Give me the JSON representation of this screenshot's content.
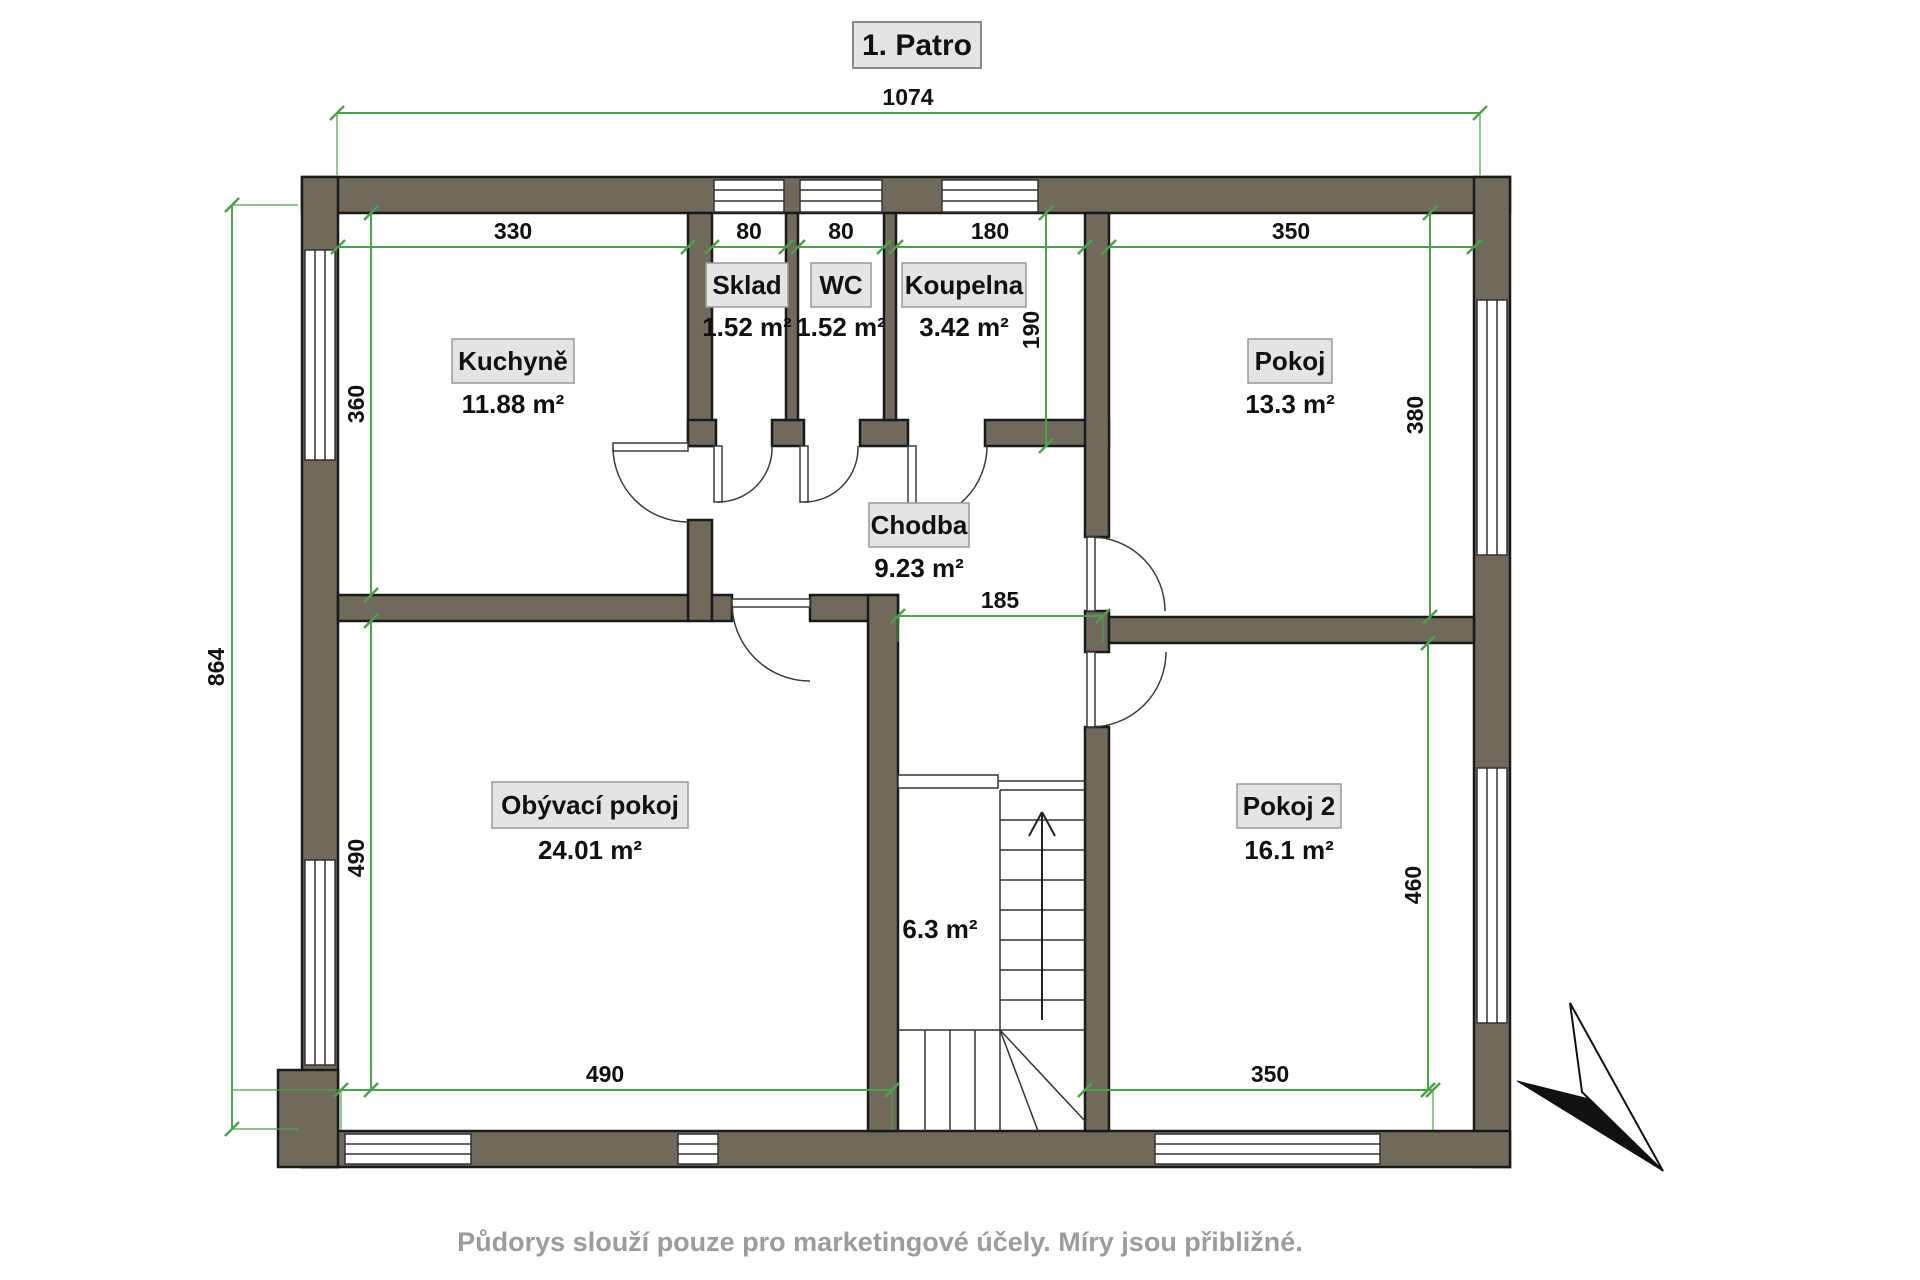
{
  "title": "1. Patro",
  "footer": "Půdorys slouží pouze pro marketingové účely. Míry jsou přibližné.",
  "colors": {
    "wall": "#706a5c",
    "dimension": "#4ea04e",
    "label_box": "#e4e4e4",
    "label_border": "#999999",
    "footer_text": "#9c9c9c"
  },
  "rooms": {
    "kuchyne": {
      "name": "Kuchyně",
      "area": "11.88 m²"
    },
    "sklad": {
      "name": "Sklad",
      "area": "1.52 m²"
    },
    "wc": {
      "name": "WC",
      "area": "1.52 m²"
    },
    "koupelna": {
      "name": "Koupelna",
      "area": "3.42 m²"
    },
    "pokoj": {
      "name": "Pokoj",
      "area": "13.3 m²"
    },
    "chodba": {
      "name": "Chodba",
      "area": "9.23 m²"
    },
    "obyvaci_pokoj": {
      "name": "Obývací pokoj",
      "area": "24.01 m²"
    },
    "pokoj2": {
      "name": "Pokoj 2",
      "area": "16.1 m²"
    },
    "schodiste": {
      "area": "6.3 m²"
    }
  },
  "dimensions": {
    "total_width": "1074",
    "total_height": "864",
    "kitchen_width": "330",
    "sklad_width": "80",
    "wc_width": "80",
    "koupelna_width": "180",
    "pokoj_width": "350",
    "kitchen_height": "360",
    "koupelna_height": "190",
    "pokoj_height": "380",
    "hall_width": "185",
    "living_height": "490",
    "pokoj2_height": "460",
    "living_width": "490",
    "pokoj2_width": "350"
  }
}
